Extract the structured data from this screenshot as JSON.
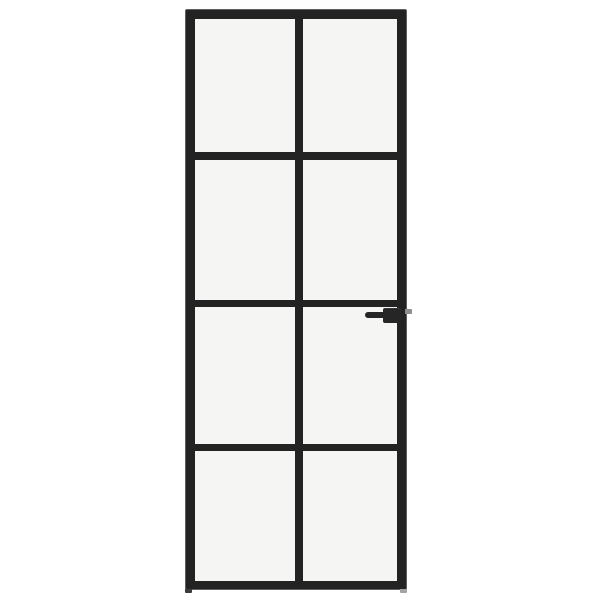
{
  "image": {
    "type": "product-photo",
    "description": "Black interior door with frosted glass and a slim steel-look frame, divided into 8 panes (2 columns by 4 rows), with a black lever handle and latch bolt on the right side, photographed on a plain white background"
  },
  "colors": {
    "background": "#ffffff",
    "frame": "#232323",
    "frame_edge": "#5f5f5f",
    "glass": "#f5f5f4",
    "handle": "#262626",
    "latch": "#8d8d8d",
    "foot_left": "#3c3c3c",
    "foot_right": "#a3a3a3"
  },
  "door": {
    "rows": 4,
    "columns": 2,
    "pane_count": 8,
    "glass_finish": "frosted",
    "handle_side": "right",
    "handle_type": "lever"
  }
}
